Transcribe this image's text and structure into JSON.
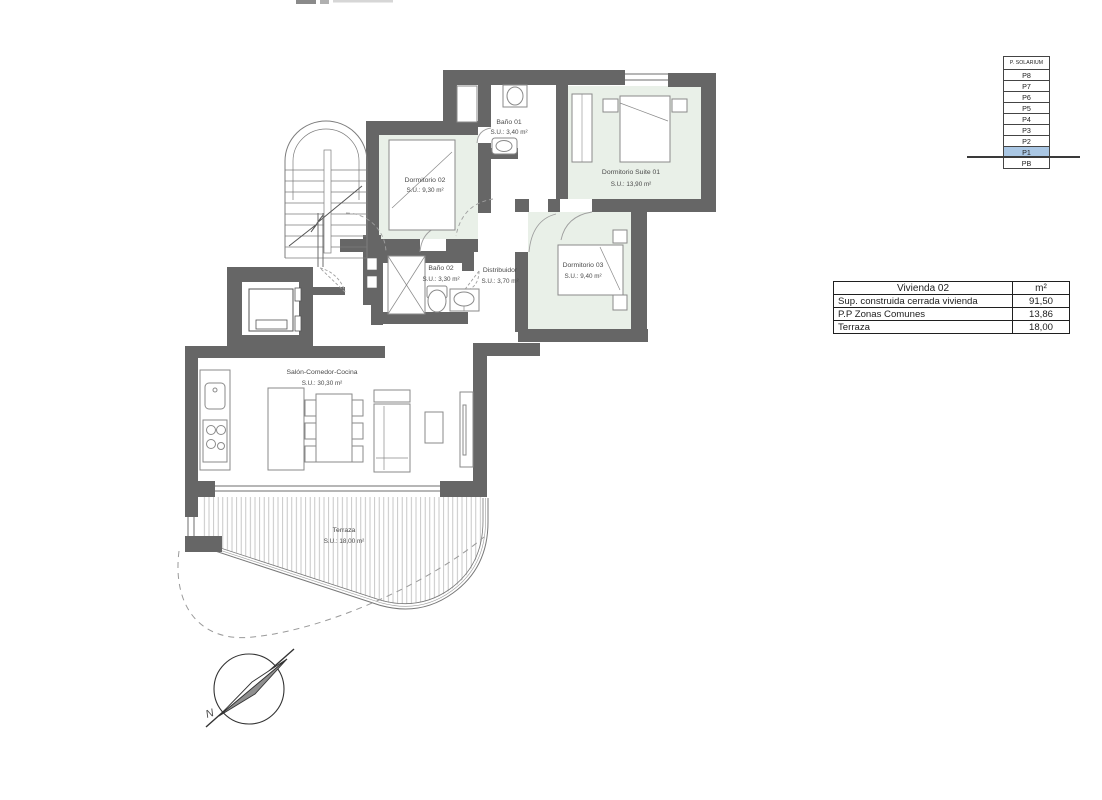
{
  "floor_selector": {
    "levels": [
      "P. SOLARIUM",
      "P8",
      "P7",
      "P6",
      "P5",
      "P4",
      "P3",
      "P2",
      "P1",
      "PB"
    ],
    "selected_level": "P1",
    "highlight_color": "#aac7e4"
  },
  "area_table": {
    "title": "Vivienda 02",
    "unit_header": "m²",
    "rows": [
      {
        "label": "Sup. construida cerrada vivienda",
        "value": "91,50"
      },
      {
        "label": "P.P Zonas Comunes",
        "value": "13,86"
      },
      {
        "label": "Terraza",
        "value": "18,00"
      }
    ]
  },
  "rooms": [
    {
      "name": "Dormitorio 02",
      "area": "S.U.: 9,30 m²"
    },
    {
      "name": "Baño 01",
      "area": "S.U.: 3,40 m²"
    },
    {
      "name": "Dormitorio Suite 01",
      "area": "S.U.: 13,90 m²"
    },
    {
      "name": "Baño 02",
      "area": "S.U.: 3,30 m²"
    },
    {
      "name": "Distribuidor",
      "area": "S.U.: 3,70 m²"
    },
    {
      "name": "Dormitorio 03",
      "area": "S.U.: 9,40 m²"
    },
    {
      "name": "Salón-Comedor-Cocina",
      "area": "S.U.: 30,30 m²"
    },
    {
      "name": "Terraza",
      "area": "S.U.: 18,00 m²"
    }
  ],
  "compass": {
    "north_label": "N"
  },
  "colors": {
    "wall": "#666666",
    "room_fill": "#e9f0e8",
    "level_highlight": "#aac7e4"
  }
}
